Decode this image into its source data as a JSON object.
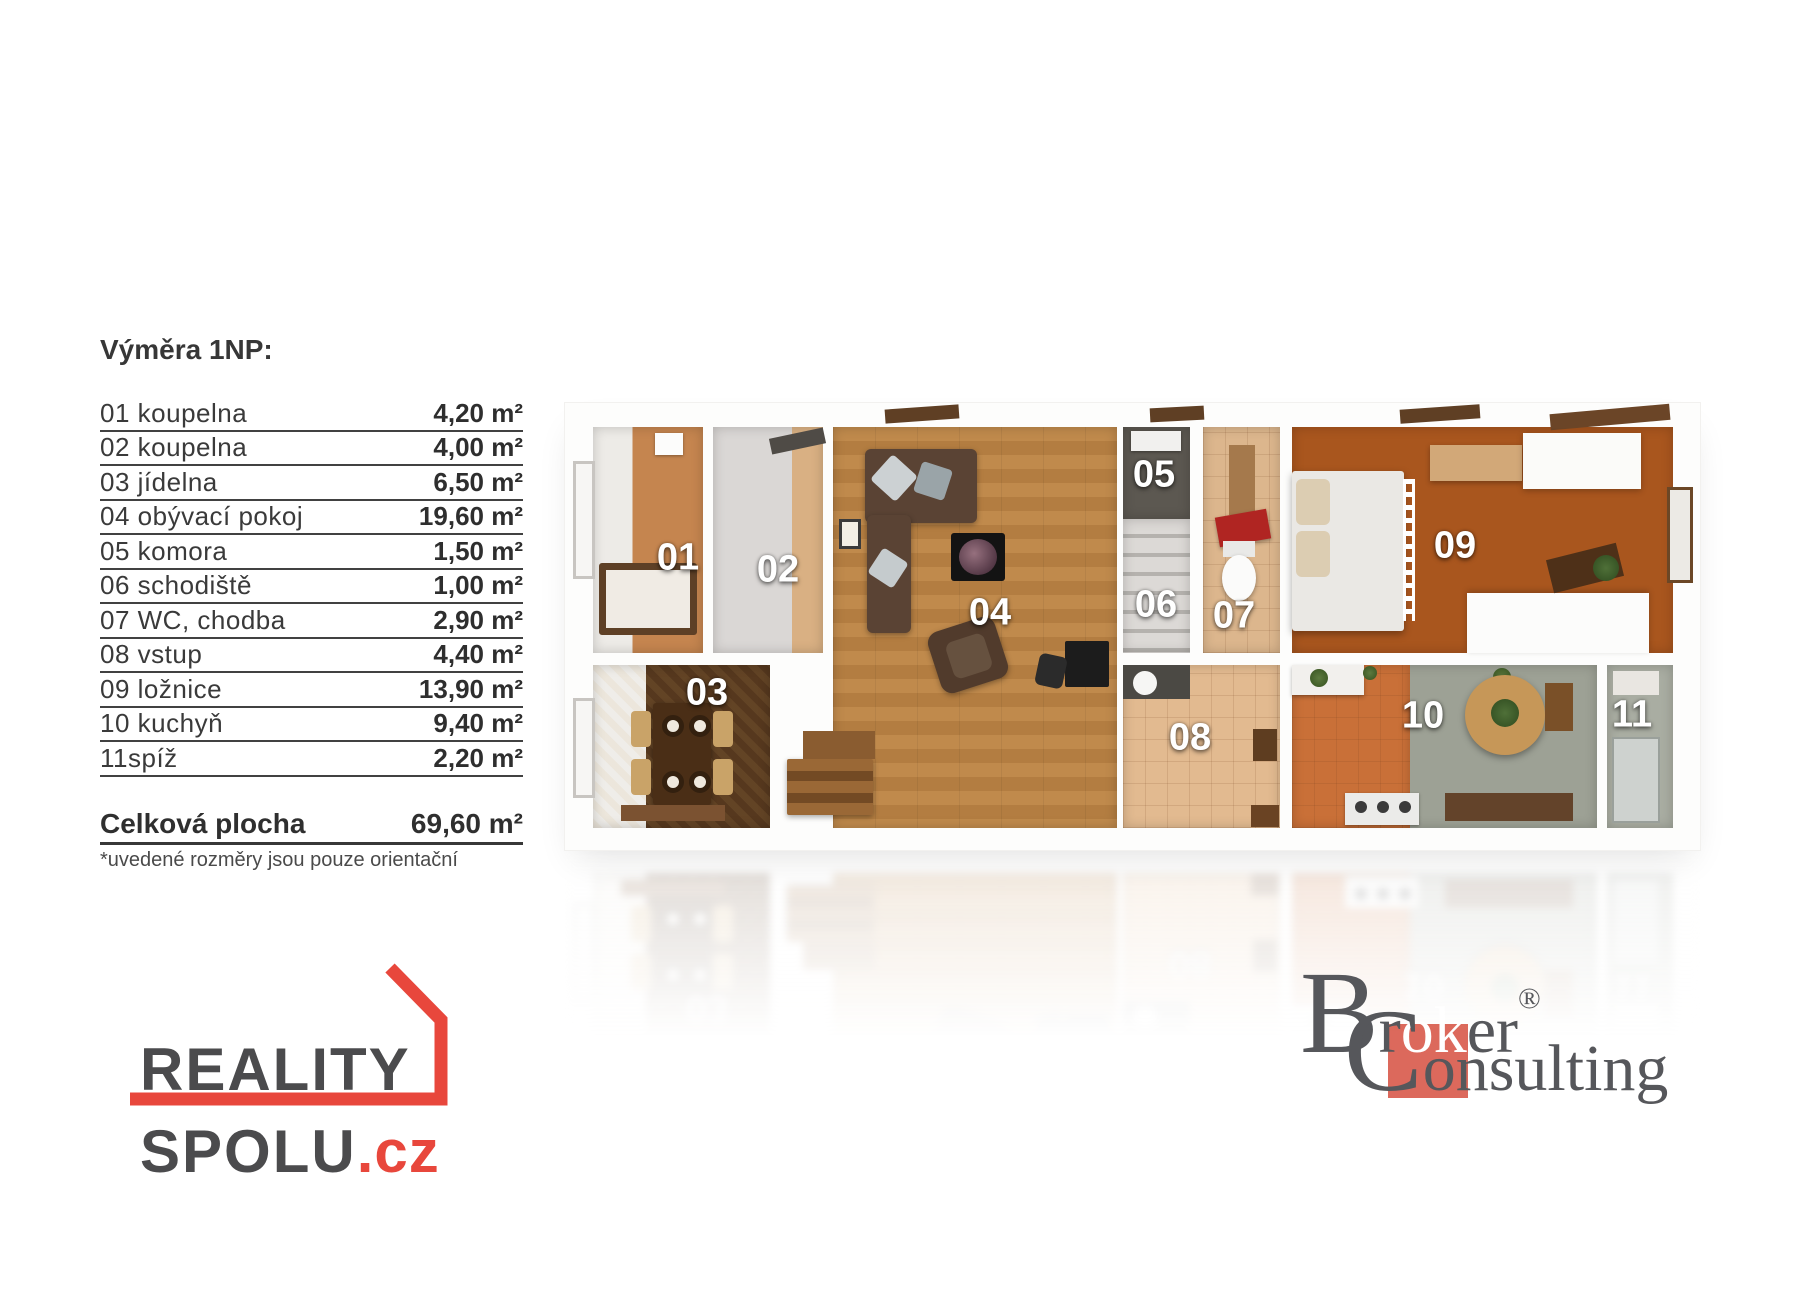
{
  "measurements": {
    "heading": "Výměra 1NP:",
    "rows": [
      {
        "label": "01 koupelna",
        "value": "4,20 m²"
      },
      {
        "label": "02 koupelna",
        "value": "4,00 m²"
      },
      {
        "label": "03 jídelna",
        "value": "6,50 m²"
      },
      {
        "label": "04 obývací pokoj",
        "value": "19,60 m²"
      },
      {
        "label": "05 komora",
        "value": "1,50 m²"
      },
      {
        "label": "06 schodiště",
        "value": "1,00 m²"
      },
      {
        "label": "07 WC, chodba",
        "value": "2,90 m²"
      },
      {
        "label": "08 vstup",
        "value": "4,40 m²"
      },
      {
        "label": "09 ložnice",
        "value": "13,90 m²"
      },
      {
        "label": "10 kuchyň",
        "value": "9,40 m²"
      },
      {
        "label": "11spíž",
        "value": "2,20 m²"
      }
    ],
    "total": {
      "label": "Celková plocha",
      "value": "69,60 m²"
    },
    "footnote": "*uvedené rozměry jsou pouze orientační"
  },
  "floor_plan": {
    "room_labels": [
      "01",
      "02",
      "03",
      "04",
      "05",
      "06",
      "07",
      "08",
      "09",
      "10",
      "11"
    ]
  },
  "logos": {
    "reality_spolu": {
      "line1": "REALITY",
      "line2": "SPOLU",
      "suffix": ".cz",
      "accent_color": "#e8473c",
      "text_color": "#4b4b4d"
    },
    "broker_consulting": {
      "b_initial": "B",
      "part1": "r",
      "highlight": "ok",
      "part2": "er",
      "registered": "®",
      "c_initial": "C",
      "line2_rest": "onsulting",
      "square_color": "#dc695c",
      "text_color": "#56575b"
    }
  }
}
